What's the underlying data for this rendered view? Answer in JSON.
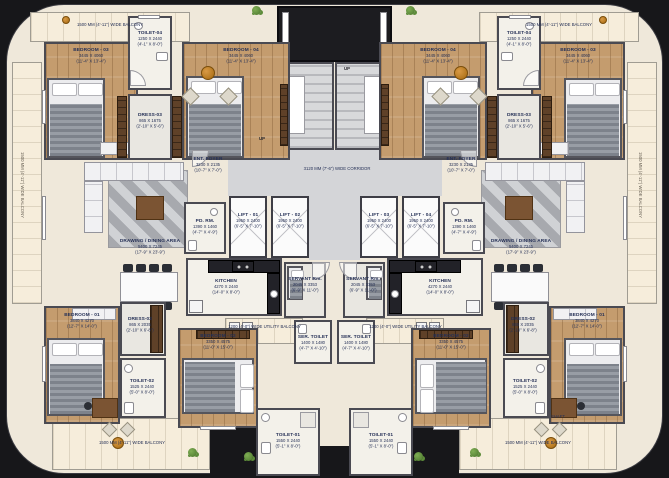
{
  "plan_title": "Typical Floor Plan - Twin Residential Units",
  "corridor_label": "3120 MM (7'-6\") WIDE CORRIDOR",
  "stair_up": "UP",
  "shaft_label": "SHAFT",
  "balcony": {
    "edge": "1500 MM (4'-11\") WIDE BALCONY",
    "utility": "1200 (4'-0\") WIDE UTILITY BALCONY"
  },
  "lifts": [
    {
      "name": "LIFT - 01",
      "mm": "1950 X 2400",
      "ft": "(6'-5\" X 7'-10\")"
    },
    {
      "name": "LIFT - 02",
      "mm": "1950 X 2400",
      "ft": "(6'-5\" X 7'-10\")"
    },
    {
      "name": "LIFT - 03",
      "mm": "1950 X 2400",
      "ft": "(6'-5\" X 7'-10\")"
    },
    {
      "name": "LIFT - 04",
      "mm": "1950 X 2400",
      "ft": "(6'-5\" X 7'-10\")"
    }
  ],
  "rooms": {
    "bedroom1": {
      "name": "BEDROOM - 01",
      "mm": "3840 X 4270",
      "ft": "(12'-7\" X 14'-0\")"
    },
    "bedroom2": {
      "name": "BEDROOM - 02",
      "mm": "3350 X 4575",
      "ft": "(11'-0\" X 15'-0\")"
    },
    "bedroom3": {
      "name": "BEDROOM - 03",
      "mm": "3445 X 4060",
      "ft": "(11'-4\" X 13'-4\")"
    },
    "bedroom4": {
      "name": "BEDROOM - 04",
      "mm": "3445 X 4060",
      "ft": "(11'-4\" X 13'-4\")"
    },
    "toilet1": {
      "name": "TOILET-01",
      "mm": "1550 X 2440",
      "ft": "(5'-1\" X 8'-0\")"
    },
    "toilet2": {
      "name": "TOILET-02",
      "mm": "1525 X 2440",
      "ft": "(5'-0\" X 8'-0\")"
    },
    "toilet4": {
      "name": "TOILET-04",
      "mm": "1250 X 2440",
      "ft": "(4'-1\" X 8'-0\")"
    },
    "dress2": {
      "name": "DRESS-02",
      "mm": "865 X 2035",
      "ft": "(2'-10\" X 6'-8\")"
    },
    "dress3": {
      "name": "DRESS-03",
      "mm": "865 X 1675",
      "ft": "(2'-10\" X 5'-6\")"
    },
    "drawing_dining": {
      "name": "DRAWING / DINING AREA",
      "mm": "5400 X 7245",
      "ft": "(17'-9\" X 23'-9\")"
    },
    "ent_foyer": {
      "name": "ENT. FOYER",
      "mm": "3230 X 2135",
      "ft": "(10'-7\" X 7'-0\")"
    },
    "pd_rm": {
      "name": "PD. RM.",
      "mm": "1390 X 1460",
      "ft": "(4'-7\" X 4'-9\")"
    },
    "kitchen": {
      "name": "KITCHEN",
      "mm": "4270 X 2440",
      "ft": "(14'-0\" X 8'-0\")"
    },
    "servant": {
      "name": "SERVANT Rm.",
      "mm": "2045 X 3353",
      "ft": "(6'-9\" X 11'-0\")"
    },
    "ser_toilet": {
      "name": "SER. TOILET",
      "mm": "1400 X 1480",
      "ft": "(4'-7\" X 4'-10\")"
    }
  },
  "colors": {
    "background": "#17171a",
    "floor_cream": "#efe8da",
    "balcony": "#f6eddb",
    "wood": "#c49c6e",
    "wall": "#4a4a52",
    "corridor": "#d4d5d8",
    "accent_plant": "#c98936"
  }
}
